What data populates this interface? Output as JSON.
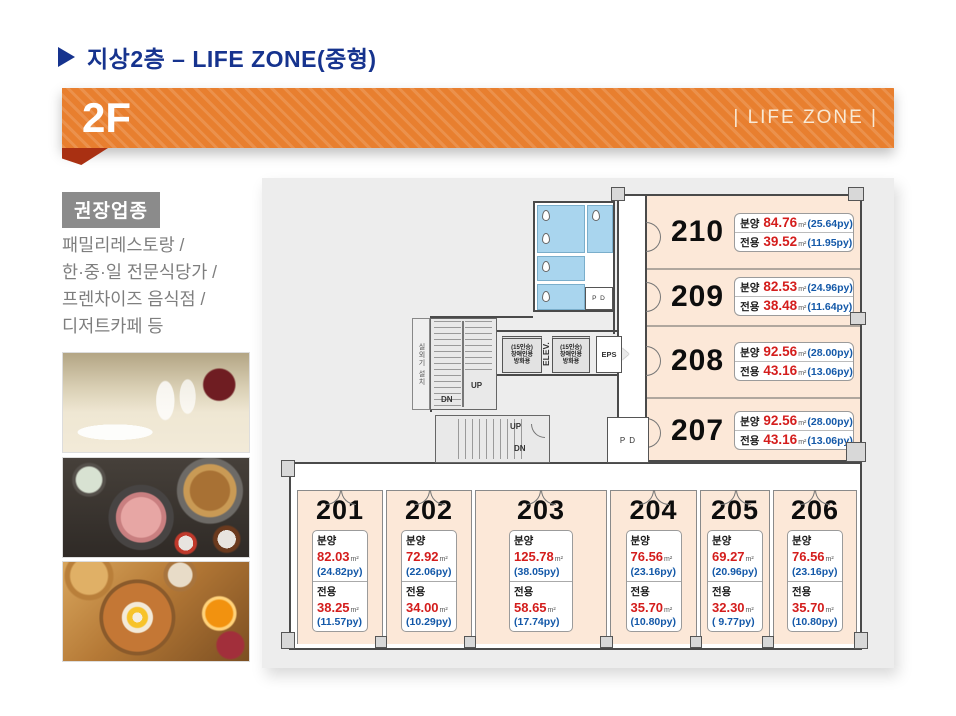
{
  "header": {
    "title": "지상2층 – LIFE ZONE(중형)"
  },
  "banner": {
    "floor_label": "2F",
    "zone_label": "| LIFE ZONE |"
  },
  "sidebar": {
    "recommend_title": "권장업종",
    "recommend_items": [
      "패밀리레스토랑 /",
      "한·중·일 전문식당가 /",
      "프렌차이즈 음식점 /",
      "디저트카페 등"
    ],
    "photo_names": [
      "restaurant-table-setting",
      "korean-course-meal",
      "breakfast-plate"
    ]
  },
  "plan": {
    "labels": {
      "bunyang": "분양",
      "jeonyong": "전용",
      "sqm": "m²",
      "up": "UP",
      "dn": "DN",
      "eps": "EPS",
      "pd": "P D",
      "elev": "ELEV.",
      "elevator_lines": [
        "(15인승)",
        "장애인용",
        "방화용"
      ],
      "outdoor_unit": "실외기 설치"
    },
    "side_units": [
      {
        "id": "210",
        "bunyang_m2": "84.76",
        "bunyang_py": "(25.64py)",
        "jeonyong_m2": "39.52",
        "jeonyong_py": "(11.95py)"
      },
      {
        "id": "209",
        "bunyang_m2": "82.53",
        "bunyang_py": "(24.96py)",
        "jeonyong_m2": "38.48",
        "jeonyong_py": "(11.64py)"
      },
      {
        "id": "208",
        "bunyang_m2": "92.56",
        "bunyang_py": "(28.00py)",
        "jeonyong_m2": "43.16",
        "jeonyong_py": "(13.06py)"
      },
      {
        "id": "207",
        "bunyang_m2": "92.56",
        "bunyang_py": "(28.00py)",
        "jeonyong_m2": "43.16",
        "jeonyong_py": "(13.06py)"
      }
    ],
    "bottom_units": [
      {
        "id": "201",
        "bunyang_m2": "82.03",
        "bunyang_py": "(24.82py)",
        "jeonyong_m2": "38.25",
        "jeonyong_py": "(11.57py)"
      },
      {
        "id": "202",
        "bunyang_m2": "72.92",
        "bunyang_py": "(22.06py)",
        "jeonyong_m2": "34.00",
        "jeonyong_py": "(10.29py)"
      },
      {
        "id": "203",
        "bunyang_m2": "125.78",
        "bunyang_py": "(38.05py)",
        "jeonyong_m2": "58.65",
        "jeonyong_py": "(17.74py)"
      },
      {
        "id": "204",
        "bunyang_m2": "76.56",
        "bunyang_py": "(23.16py)",
        "jeonyong_m2": "35.70",
        "jeonyong_py": "(10.80py)"
      },
      {
        "id": "205",
        "bunyang_m2": "69.27",
        "bunyang_py": "(20.96py)",
        "jeonyong_m2": "32.30",
        "jeonyong_py": "( 9.77py)"
      },
      {
        "id": "206",
        "bunyang_m2": "76.56",
        "bunyang_py": "(23.16py)",
        "jeonyong_m2": "35.70",
        "jeonyong_py": "(10.80py)"
      }
    ]
  },
  "colors": {
    "accent_orange": "#E87F2F",
    "fold_red": "#A93012",
    "title_blue": "#16338E",
    "value_red": "#D41D1C",
    "py_blue": "#1358A8",
    "unit_fill": "#FCE8D8",
    "bathroom_blue": "#A9D5EE",
    "recommend_gray": "#8B8B8B"
  }
}
